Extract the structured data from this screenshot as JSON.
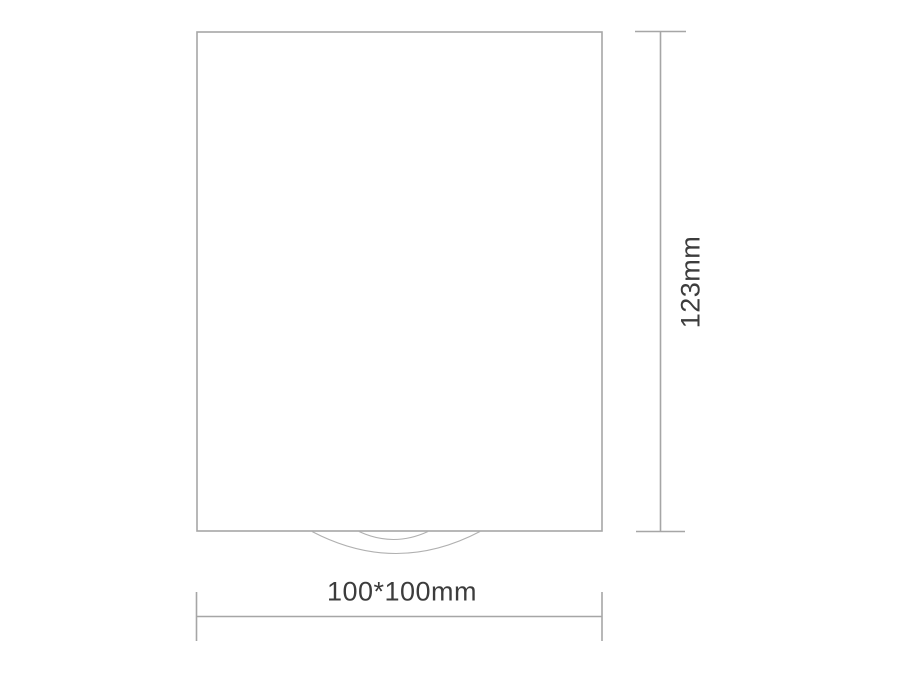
{
  "page": {
    "background_color": "#ffffff",
    "line_color": "#a6a6a6",
    "arc_line_color": "#b0b0b0",
    "text_color": "#3c3c3c"
  },
  "diagram": {
    "kind": "technical-dimension-drawing",
    "height_dimension": {
      "label": "123mm"
    },
    "width_dimension": {
      "label": "100*100mm"
    }
  }
}
